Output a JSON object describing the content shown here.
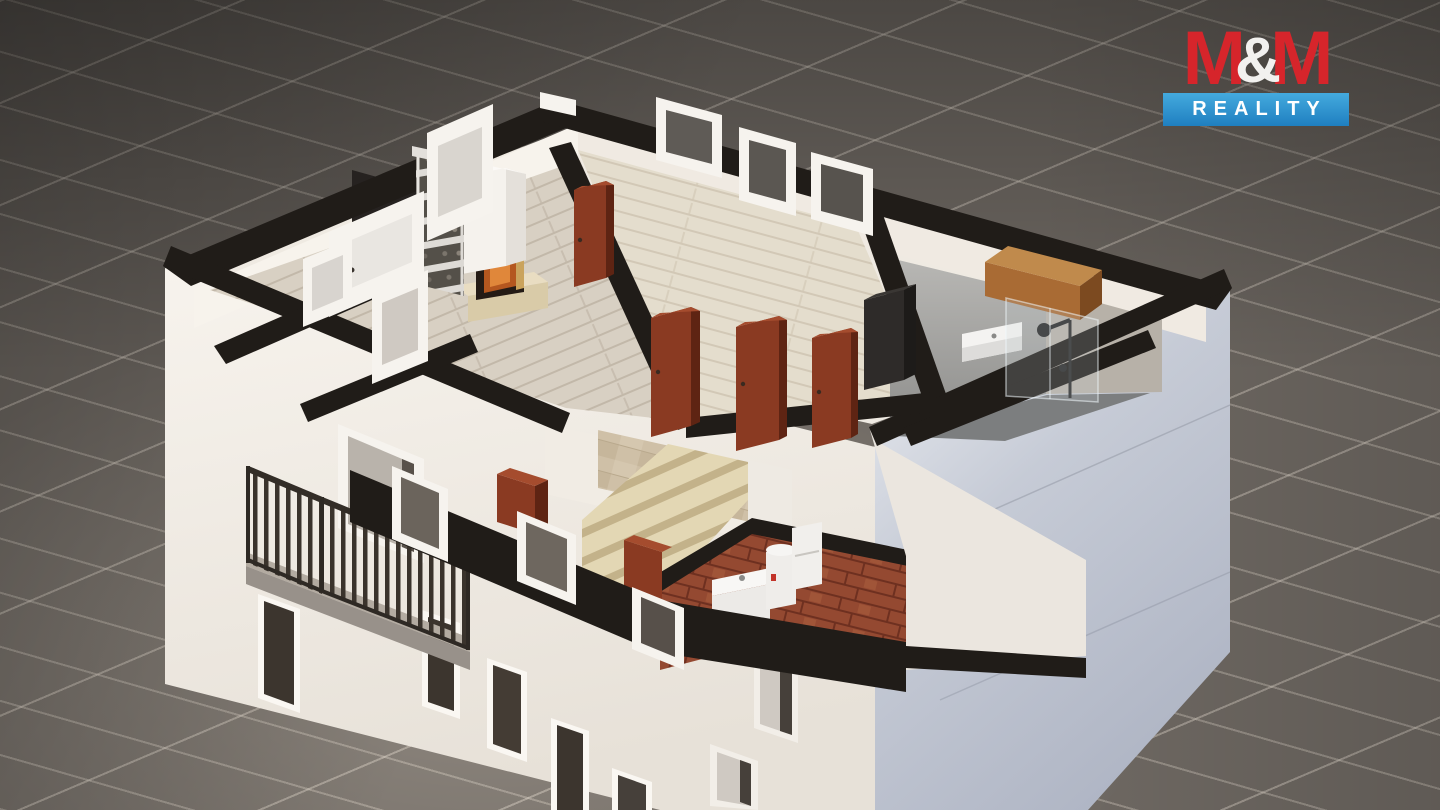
{
  "logo": {
    "m1": "M",
    "amp": "&",
    "m2": "M",
    "tagline": "REALITY"
  },
  "colors": {
    "ground-tile": "#6f6963",
    "grout": "#e0d7cb",
    "wall-white": "#f3efe9",
    "facade-shadow": "#c0c6d2",
    "cut-top": "#201c18",
    "wood-floor-living": "#d8d0c3",
    "wood-floor-bedroom": "#e4ddcd",
    "travertine": "#cfc0a7",
    "stair-tread": "#e3d7b4",
    "door-brown": "#8a3a22",
    "brick": "#944931",
    "bath-concrete": "#a5a4a1",
    "wood-cabinet": "#b97c42",
    "railing": "#3a332c",
    "logo-red": "#d6252b",
    "logo-amp": "#f2f1ef",
    "logo-blue-top": "#44aade",
    "logo-blue-bottom": "#1f7fc0",
    "logo-text": "#ffffff"
  },
  "scene": {
    "type": "isometric-cutaway-floorplan-render",
    "elements": [
      "tiled-ground",
      "white-facade",
      "shadow-facade",
      "cut-wall-tops",
      "living-room-wood-floor",
      "bedroom-wood-floor",
      "bathroom",
      "glass-shower",
      "shower-fixture",
      "bathroom-sink",
      "wooden-cabinet",
      "wardrobe",
      "staircase",
      "travertine-landing",
      "brick-utility-room",
      "utility-sink",
      "water-heater",
      "balcony-railing",
      "balcony-slab",
      "fireplace",
      "chimney",
      "firewood-rack",
      "interior-doors",
      "window-frames",
      "facade-windows"
    ]
  }
}
